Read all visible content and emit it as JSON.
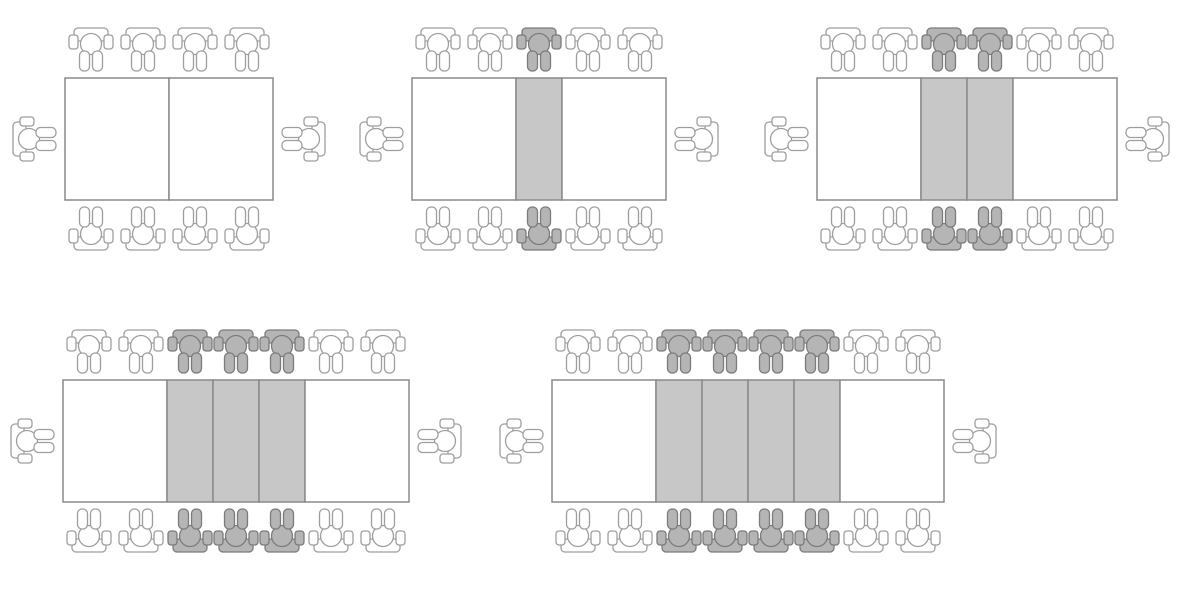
{
  "page": {
    "title": "Table seating growing pattern",
    "background": "#ffffff"
  },
  "colors": {
    "table_border": "#8a8a8a",
    "table_fill": "#ffffff",
    "leaf_fill": "#c7c7c7",
    "chair_outline": "#9e9e9e",
    "chair_fill": "#ffffff",
    "highlight_chair_fill": "#b5b5b5",
    "highlight_chair_outline": "#7b7b7b"
  },
  "diagram": {
    "type": "seating-pattern-sequence",
    "description": "Rectangular table built from two white end sections plus shaded extension leaves; each leaf adds one seat on each long side, with one seat at each end.",
    "figures": [
      {
        "step": 1,
        "white_sections": 2,
        "leaf_sections": 0,
        "seats_top": 4,
        "seats_bottom": 4,
        "seats_ends": 2,
        "highlighted_seats": 0,
        "total_seats": 10
      },
      {
        "step": 2,
        "white_sections": 2,
        "leaf_sections": 1,
        "seats_top": 5,
        "seats_bottom": 5,
        "seats_ends": 2,
        "highlighted_seats": 2,
        "total_seats": 12
      },
      {
        "step": 3,
        "white_sections": 2,
        "leaf_sections": 2,
        "seats_top": 6,
        "seats_bottom": 6,
        "seats_ends": 2,
        "highlighted_seats": 4,
        "total_seats": 14
      },
      {
        "step": 4,
        "white_sections": 2,
        "leaf_sections": 3,
        "seats_top": 7,
        "seats_bottom": 7,
        "seats_ends": 2,
        "highlighted_seats": 6,
        "total_seats": 16
      },
      {
        "step": 5,
        "white_sections": 2,
        "leaf_sections": 4,
        "seats_top": 8,
        "seats_bottom": 8,
        "seats_ends": 2,
        "highlighted_seats": 8,
        "total_seats": 18
      }
    ]
  }
}
